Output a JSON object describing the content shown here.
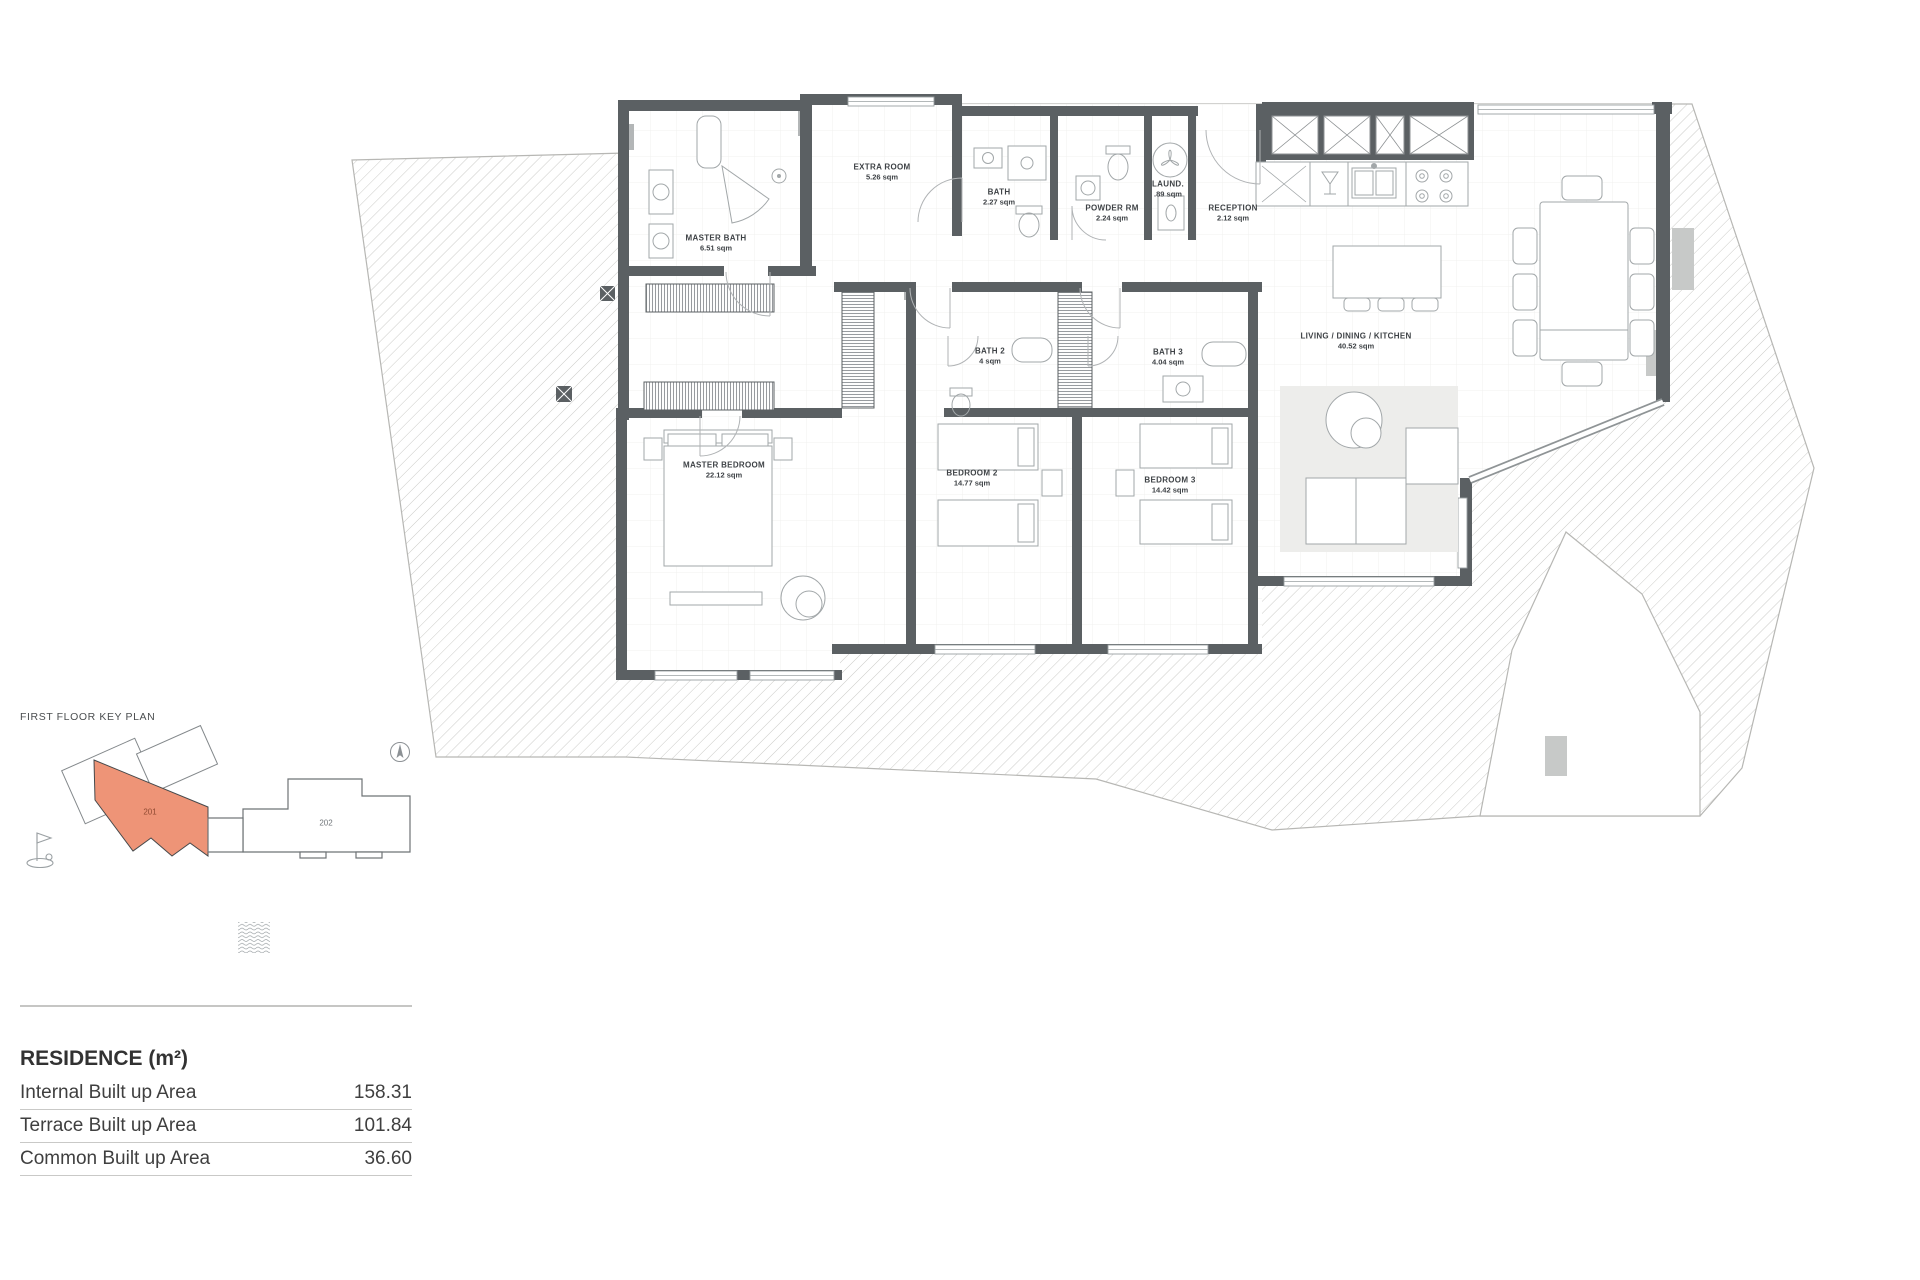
{
  "colors": {
    "wall": "#5b6063",
    "hatch_line": "#cbcbc8",
    "highlight_unit": "#ee9477",
    "furniture_line": "#a2a7a9"
  },
  "plan": {
    "rooms": [
      {
        "name": "MASTER BATH",
        "area": "6.51 sqm"
      },
      {
        "name": "EXTRA ROOM",
        "area": "5.26 sqm"
      },
      {
        "name": "BATH",
        "area": "2.27 sqm"
      },
      {
        "name": "POWDER RM",
        "area": "2.24 sqm"
      },
      {
        "name": "LAUND.",
        "area": ".89 sqm"
      },
      {
        "name": "RECEPTION",
        "area": "2.12 sqm"
      },
      {
        "name": "MASTER BEDROOM",
        "area": "22.12 sqm"
      },
      {
        "name": "BEDROOM 2",
        "area": "14.77 sqm"
      },
      {
        "name": "BEDROOM 3",
        "area": "14.42 sqm"
      },
      {
        "name": "BATH 2",
        "area": "4 sqm"
      },
      {
        "name": "BATH 3",
        "area": "4.04 sqm"
      },
      {
        "name": "LIVING / DINING / KITCHEN",
        "area": "40.52 sqm"
      }
    ]
  },
  "key_plan": {
    "title": "FIRST FLOOR KEY PLAN",
    "units": [
      {
        "id": "201",
        "highlighted": true
      },
      {
        "id": "202",
        "highlighted": false
      }
    ],
    "icons": [
      "golf-flag-icon",
      "north-compass-icon",
      "water-waves-icon"
    ]
  },
  "residence_table": {
    "title": "RESIDENCE (m²)",
    "rows": [
      {
        "label": "Internal Built up Area",
        "value": "158.31"
      },
      {
        "label": "Terrace Built up Area",
        "value": "101.84"
      },
      {
        "label": "Common Built up Area",
        "value": "36.60"
      }
    ]
  }
}
